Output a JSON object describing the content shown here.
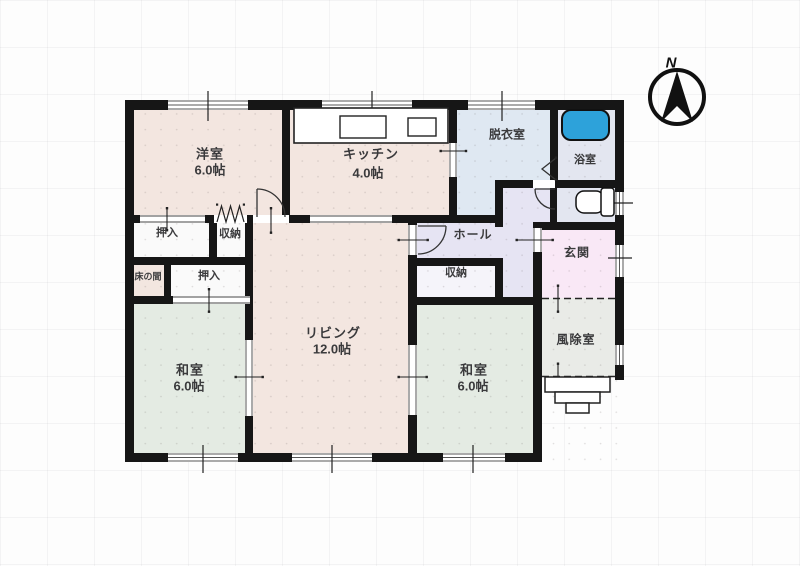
{
  "title": "floor-plan",
  "rooms": {
    "yoshitsu": {
      "name": "洋室",
      "size": "6.0帖"
    },
    "kitchen": {
      "name": "キッチン",
      "size": "4.0帖"
    },
    "datsuiishitsu": {
      "name": "脱衣室"
    },
    "yokushitsu": {
      "name": "浴室"
    },
    "oshiire_1": {
      "name": "押入"
    },
    "shuunou_1": {
      "name": "収納"
    },
    "tokonoma": {
      "name": "床の間"
    },
    "oshiire_2": {
      "name": "押入"
    },
    "hall": {
      "name": "ホール"
    },
    "genkan": {
      "name": "玄関"
    },
    "shuunou_2": {
      "name": "収納"
    },
    "living": {
      "name": "リビング",
      "size": "12.0帖"
    },
    "washitsu_1": {
      "name": "和室",
      "size": "6.0帖"
    },
    "washitsu_2": {
      "name": "和室",
      "size": "6.0帖"
    },
    "fujoshitsu": {
      "name": "風除室"
    }
  },
  "compass": {
    "label": "N",
    "direction": "up"
  },
  "fixtures": [
    "kitchen-counter",
    "sink",
    "stove",
    "bathtub",
    "toilet",
    "entrance-steps"
  ],
  "colors": {
    "wall": "#161616",
    "western_room_floor": "#f3e6e0",
    "tatami_room_floor": "#e4ebe3",
    "dressing_room_floor": "#dfe8f2",
    "bath_floor": "#e3e6f0",
    "hall_floor": "#e6e4f3",
    "entrance_floor": "#f9e8f6",
    "windbreak_floor": "#e9ebe7",
    "closet_floor": "#fafafa",
    "bathtub_fill": "#2da2da"
  }
}
